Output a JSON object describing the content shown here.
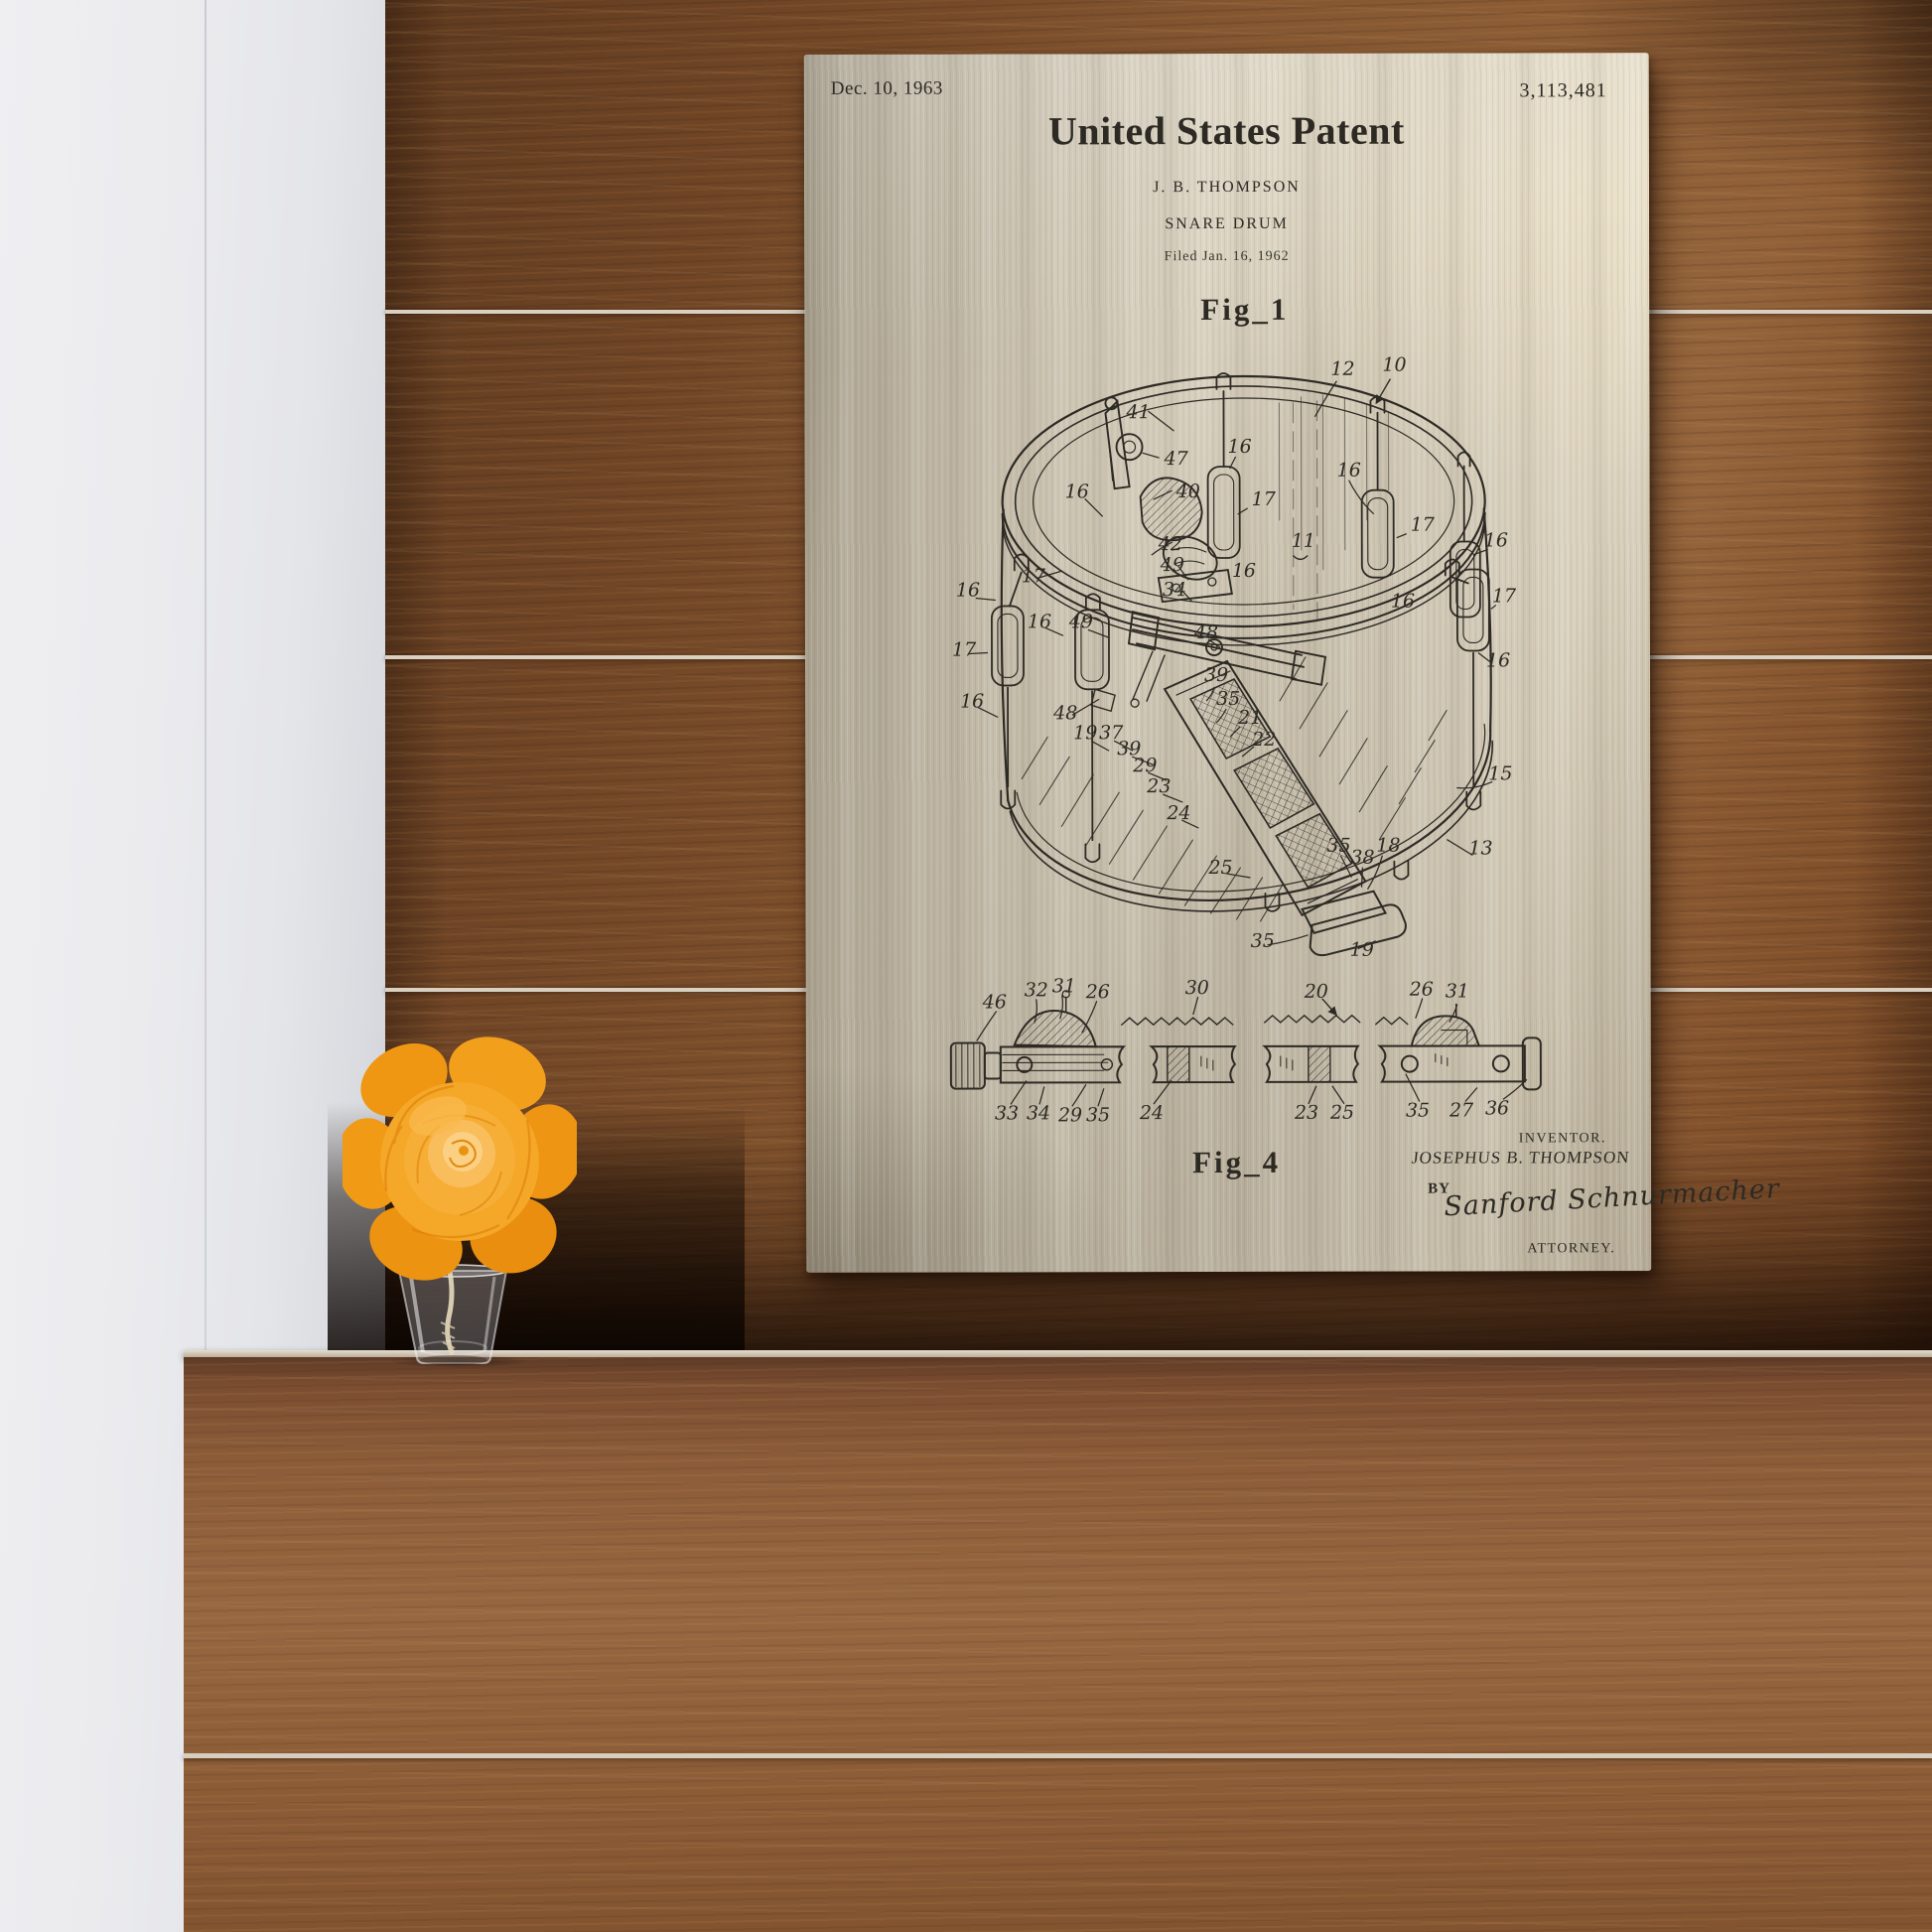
{
  "palette": {
    "poster_metal": "#cfc6b4",
    "poster_ink": "#2d2a24",
    "wood_wall": "#7a4e2b",
    "wood_shelf": "#8f5f3a",
    "white_wall": "#e9e9ec",
    "flower_orange": "#f5a728"
  },
  "poster": {
    "date": "Dec. 10, 1963",
    "patent_number": "3,113,481",
    "title": "United States Patent",
    "inventor_line": "J. B. THOMPSON",
    "subject": "SNARE DRUM",
    "filed_line": "Filed Jan. 16, 1962",
    "fig1_caption": "Fig_1",
    "fig4_caption": "Fig_4",
    "inventor_label": "INVENTOR.",
    "inventor_name": "JOSEPHUS B. THOMPSON",
    "by_label": "BY",
    "signature": "Sanford Schnurmacher",
    "attorney_label": "ATTORNEY.",
    "fig1_labels": [
      "12",
      "10",
      "41",
      "47",
      "16",
      "40",
      "17",
      "16",
      "16",
      "17",
      "11",
      "42",
      "49",
      "34",
      "16",
      "16",
      "16",
      "17",
      "16",
      "17",
      "16",
      "16",
      "49",
      "17",
      "16",
      "48",
      "48",
      "19",
      "37",
      "39",
      "35",
      "21",
      "22",
      "39",
      "29",
      "23",
      "24",
      "25",
      "15",
      "13",
      "35",
      "38",
      "18",
      "35",
      "19"
    ],
    "fig4_labels_top": [
      "46",
      "32",
      "31",
      "26",
      "30",
      "20",
      "26",
      "31"
    ],
    "fig4_labels_bottom": [
      "33",
      "34",
      "29",
      "35",
      "24",
      "23",
      "25",
      "35",
      "27",
      "36"
    ]
  }
}
